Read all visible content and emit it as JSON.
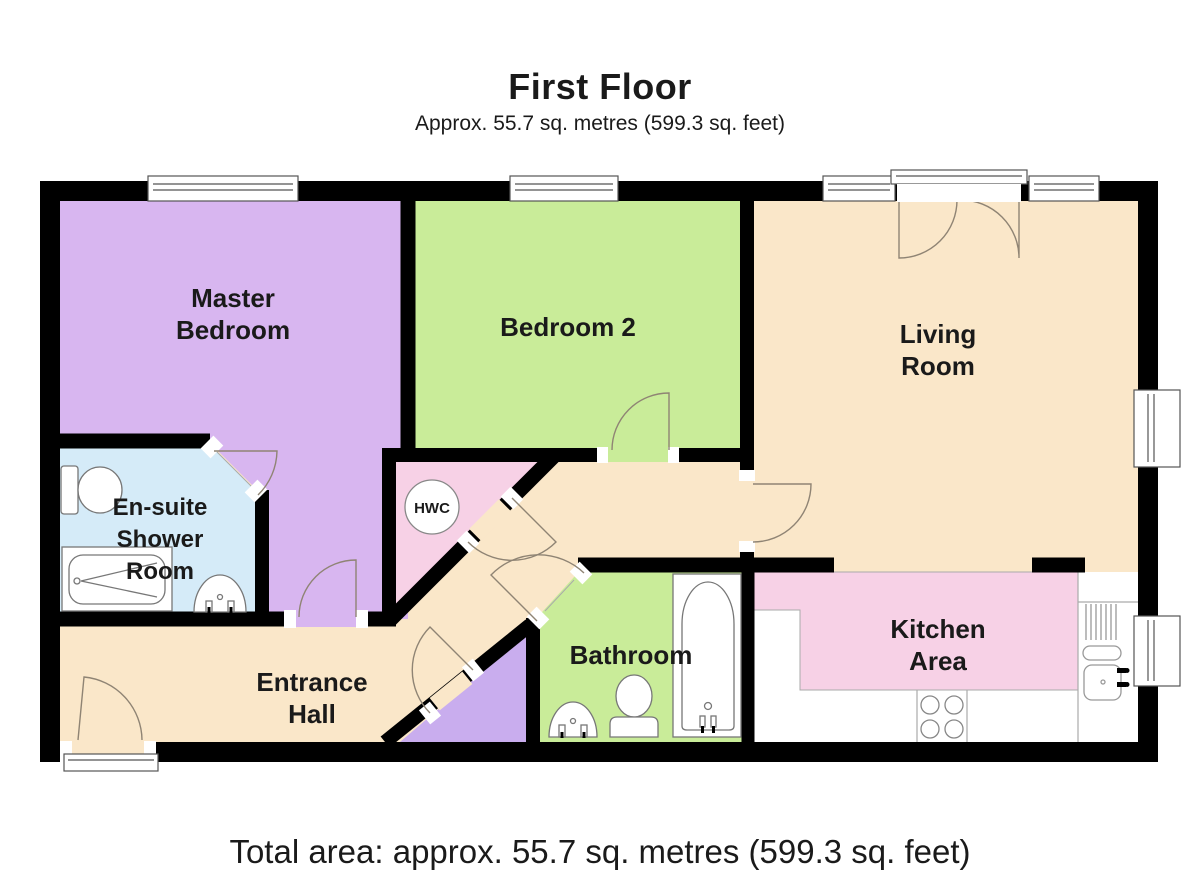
{
  "header": {
    "title": "First Floor",
    "subtitle": "Approx. 55.7 sq. metres (599.3 sq. feet)"
  },
  "footer": {
    "total_area": "Total area: approx. 55.7 sq. metres (599.3 sq. feet)"
  },
  "rooms": {
    "master_bedroom": {
      "name": "Master Bedroom",
      "lines": [
        "Master",
        "Bedroom"
      ],
      "color": "#d8b6f0"
    },
    "bedroom2": {
      "name": "Bedroom 2",
      "lines": [
        "Bedroom 2"
      ],
      "color": "#c9ec99"
    },
    "living_room": {
      "name": "Living Room",
      "lines": [
        "Living",
        "Room"
      ],
      "color": "#fae7c9"
    },
    "ensuite": {
      "name": "En-suite Shower Room",
      "lines": [
        "En-suite",
        "Shower",
        "Room"
      ],
      "color": "#d5ebf8"
    },
    "entrance_hall": {
      "name": "Entrance Hall",
      "lines": [
        "Entrance",
        "Hall"
      ],
      "color": "#fae7c9"
    },
    "bathroom": {
      "name": "Bathroom",
      "lines": [
        "Bathroom"
      ],
      "color": "#c9ec99"
    },
    "kitchen": {
      "name": "Kitchen Area",
      "lines": [
        "Kitchen",
        "Area"
      ],
      "color": "#f7d1e6"
    },
    "hwc_cupboard": {
      "label": "HWC",
      "color": "#f7d1e6"
    },
    "stair_cupboard": {
      "color": "#c9adee"
    }
  },
  "colors": {
    "wall": "#000000",
    "hall_floor": "#fae7c9",
    "door_arc": "#8f8474",
    "fixture_outline": "#777777",
    "counter_line": "#aaaaaa",
    "window_frame": "#555555"
  }
}
